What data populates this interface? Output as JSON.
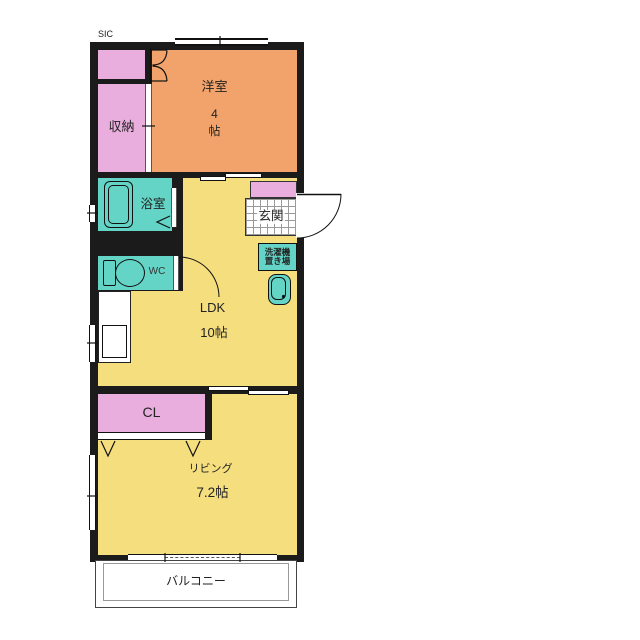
{
  "plan": {
    "sic_label": "SIC",
    "rooms": {
      "storage": {
        "label": "収納"
      },
      "western": {
        "label": "洋室",
        "size_value": "4",
        "size_unit": "帖"
      },
      "bath": {
        "label": "浴室"
      },
      "wc": {
        "label": "WC"
      },
      "entrance": {
        "label": "玄関"
      },
      "laundry": {
        "label_line1": "洗濯機",
        "label_line2": "置き場"
      },
      "ldk": {
        "label": "LDK",
        "size": "10帖"
      },
      "closet": {
        "label": "CL"
      },
      "living": {
        "label": "リビング",
        "size": "7.2帖"
      },
      "balcony": {
        "label": "バルコニー"
      }
    },
    "colors": {
      "wall": "#1b1b1b",
      "floor_yellow": "#F5DE7E",
      "room_orange": "#F2A36B",
      "closet_pink": "#E9AEDD",
      "wet_area_teal": "#63D4C6",
      "background": "#FFFFFF"
    }
  }
}
